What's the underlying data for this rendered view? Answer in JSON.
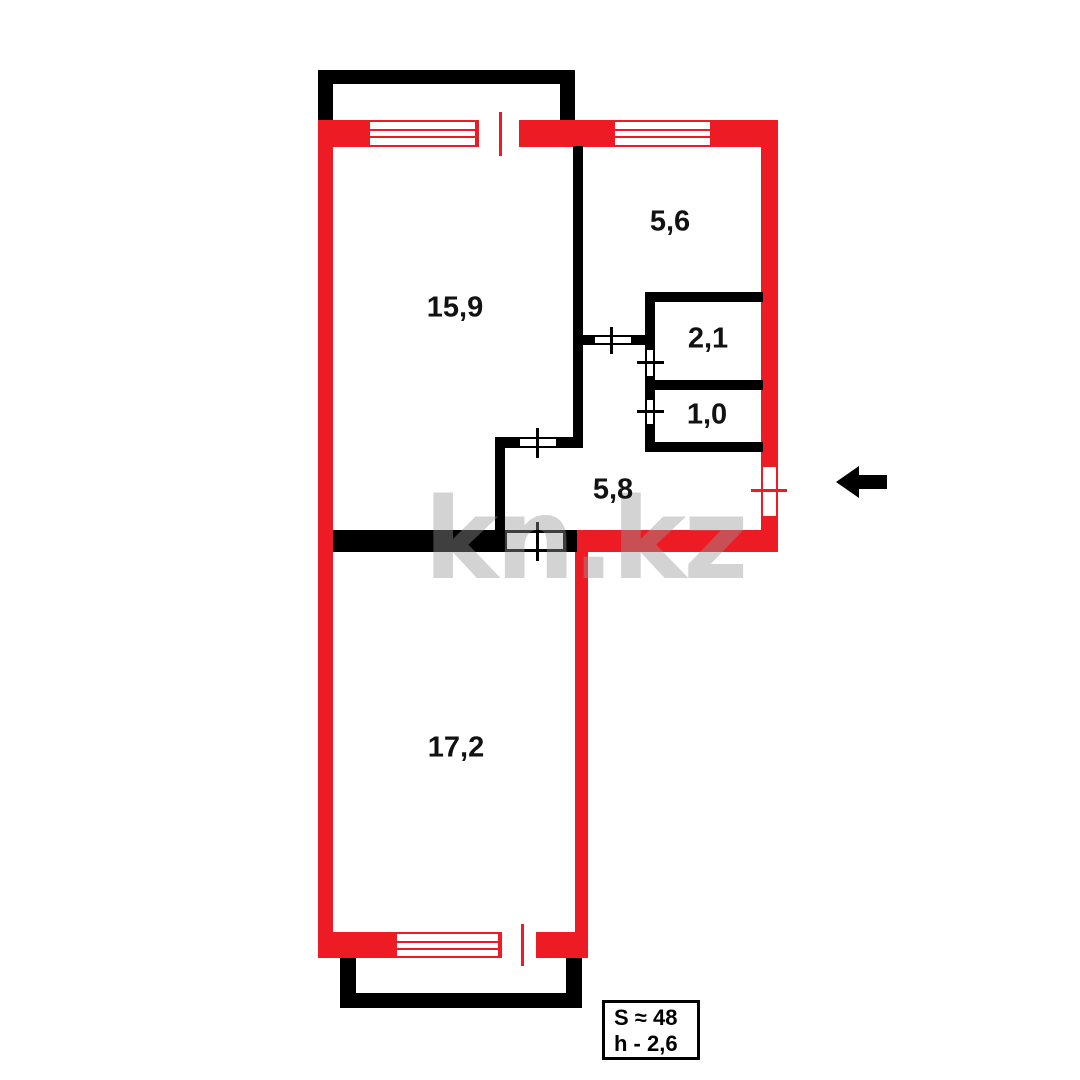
{
  "plan": {
    "watermark": "kn.kz",
    "rooms": [
      {
        "id": "living-room",
        "area": "15,9"
      },
      {
        "id": "kitchen",
        "area": "5,6"
      },
      {
        "id": "bathroom",
        "area": "2,1"
      },
      {
        "id": "toilet",
        "area": "1,0"
      },
      {
        "id": "hallway",
        "area": "5,8"
      },
      {
        "id": "bedroom",
        "area": "17,2"
      }
    ],
    "legend": {
      "total_area": "S ≈ 48",
      "ceiling_height": "h - 2,6"
    },
    "icons": {
      "entrance_arrow": "left-arrow"
    },
    "colors": {
      "load_bearing_wall": "#ED1C24",
      "partition_wall": "#000000",
      "background": "#FFFFFF"
    }
  }
}
